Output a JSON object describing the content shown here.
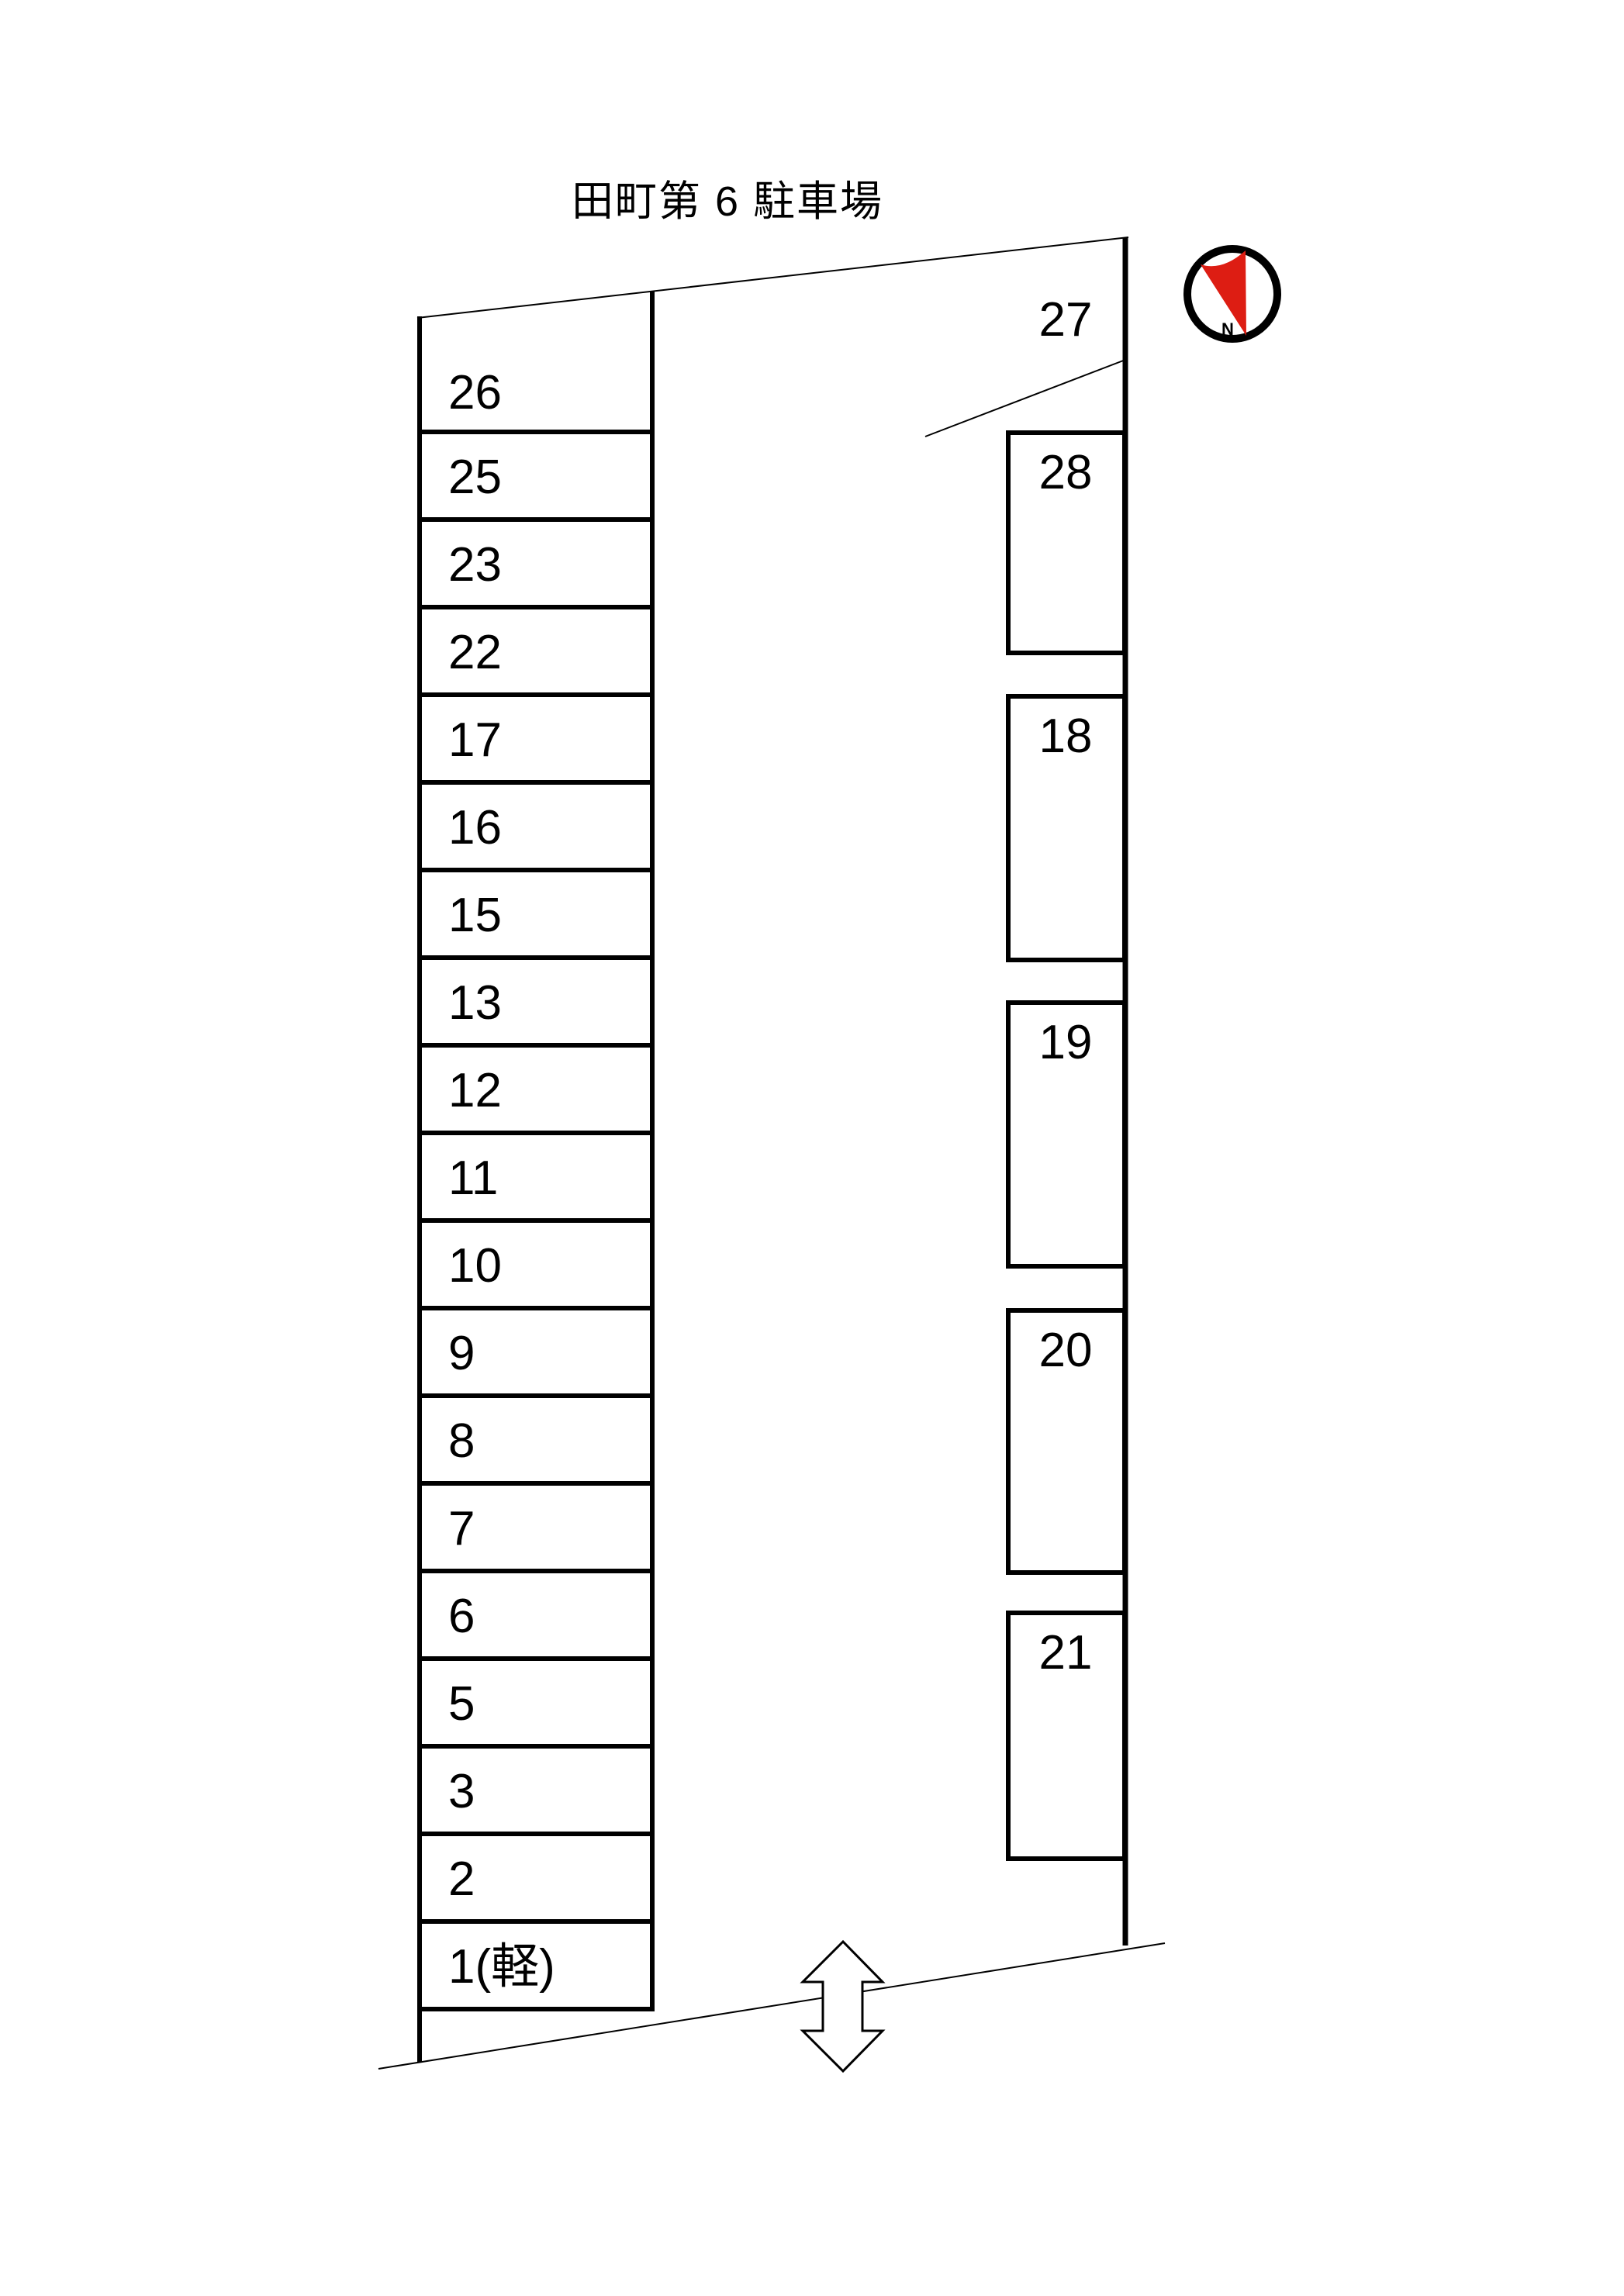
{
  "page": {
    "title": "田町第 6 駐車場"
  },
  "compass": {
    "north_label": "N",
    "needle_color": "#dd1d13",
    "ring_color": "#000000"
  },
  "lot": {
    "left_column_spaces": [
      "26",
      "25",
      "23",
      "22",
      "17",
      "16",
      "15",
      "13",
      "12",
      "11",
      "10",
      "9",
      "8",
      "7",
      "6",
      "5",
      "3",
      "2",
      "1(軽)"
    ],
    "open_space_label": "27",
    "right_column_spaces": [
      "28",
      "18",
      "19",
      "20",
      "21"
    ],
    "line_color": "#000000"
  }
}
